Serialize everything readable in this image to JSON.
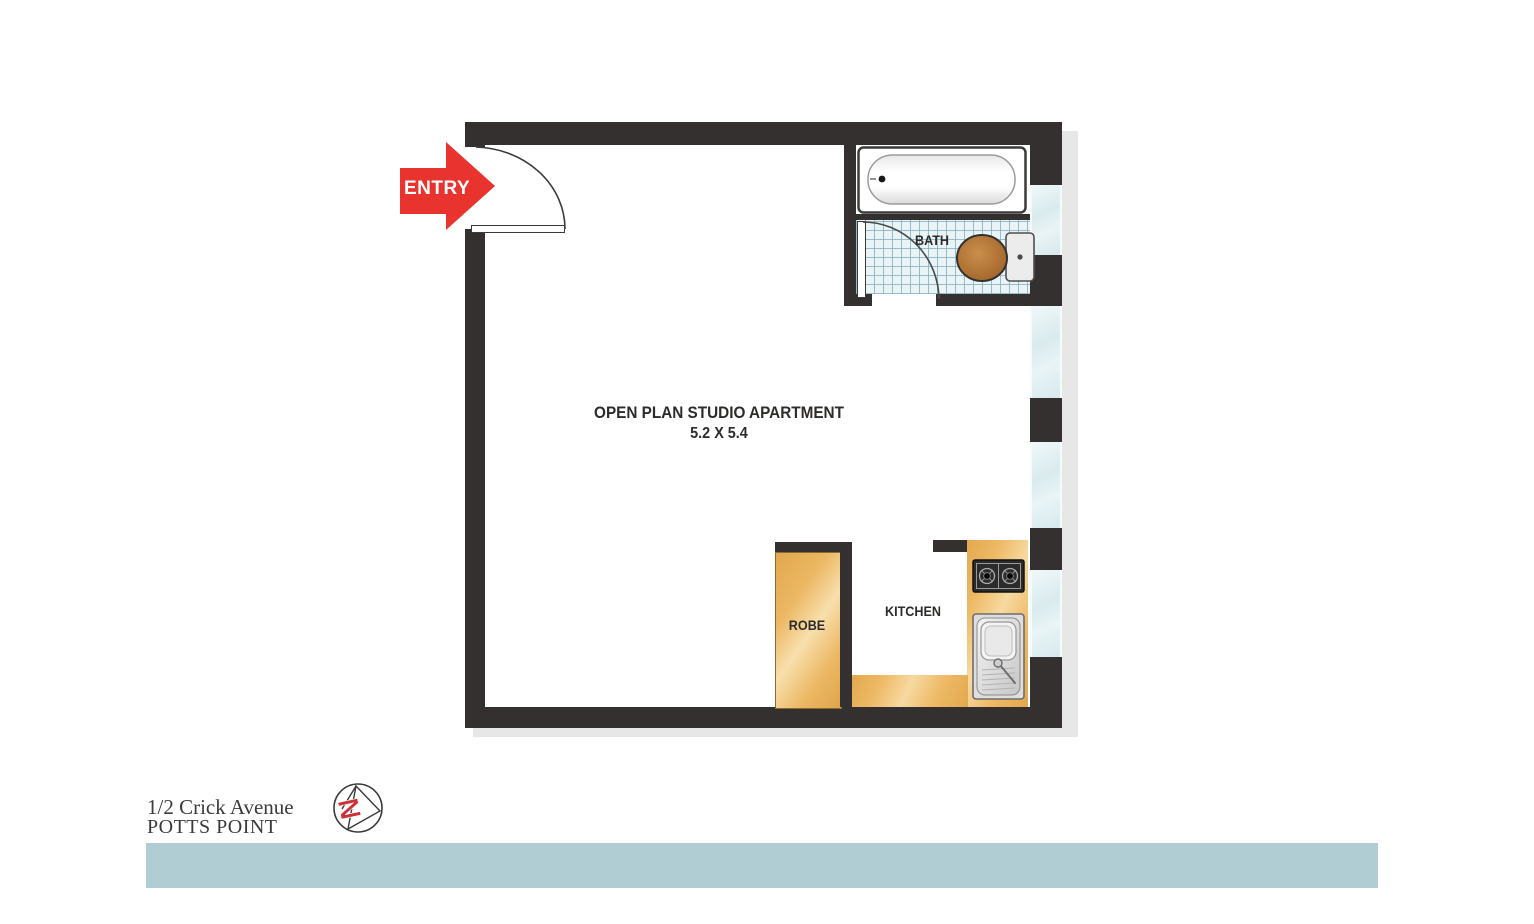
{
  "plan": {
    "entry_label": "ENTRY",
    "bath_label": "BATH",
    "kitchen_label": "KITCHEN",
    "robe_label": "ROBE",
    "main_room_label": "OPEN PLAN STUDIO APARTMENT",
    "main_room_dimensions": "5.2 X 5.4"
  },
  "footer": {
    "address_line1": "1/2 Crick Avenue",
    "address_line2": "POTTS POINT",
    "north_letter": "N"
  },
  "colors": {
    "wall": "#33302f",
    "entry_arrow_red": "#e8332e",
    "counter_tan": "#ecb65f",
    "window_glass": "#ddedf0",
    "tile_background": "#eaf3f5",
    "footer_bar": "#b0cdd4",
    "toilet_seat_brown": "#a96f35",
    "drop_shadow": "#e7e7e7"
  }
}
